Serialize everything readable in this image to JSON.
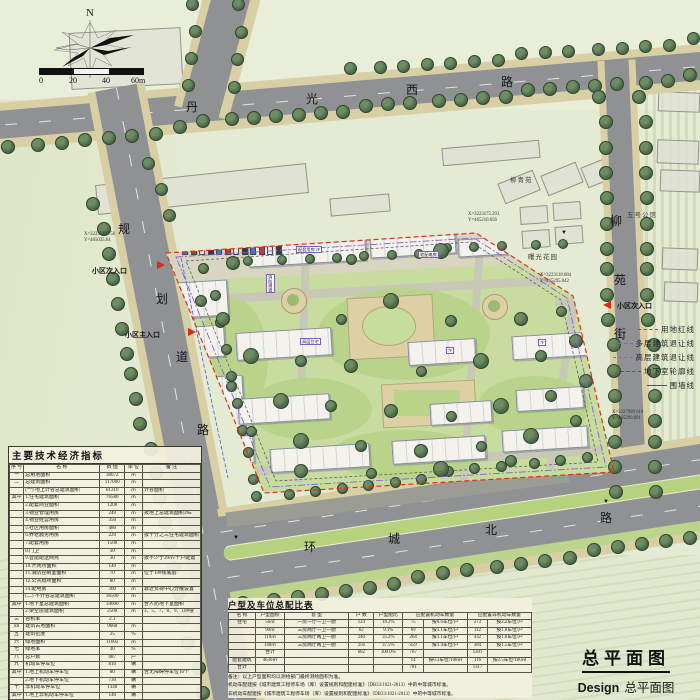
{
  "compass": {
    "north_label": "N"
  },
  "scale_bar": {
    "labels": [
      "0",
      "20",
      "40",
      "60m"
    ]
  },
  "road_name_chars": [
    {
      "text": "丹",
      "x": 186,
      "y": 98
    },
    {
      "text": "光",
      "x": 306,
      "y": 90
    },
    {
      "text": "西",
      "x": 406,
      "y": 81
    },
    {
      "text": "路",
      "x": 501,
      "y": 73
    },
    {
      "text": "规",
      "x": 118,
      "y": 220
    },
    {
      "text": "划",
      "x": 156,
      "y": 290
    },
    {
      "text": "道",
      "x": 176,
      "y": 348
    },
    {
      "text": "路",
      "x": 197,
      "y": 421
    },
    {
      "text": "柳",
      "x": 610,
      "y": 212
    },
    {
      "text": "苑",
      "x": 614,
      "y": 271
    },
    {
      "text": "街",
      "x": 614,
      "y": 325
    },
    {
      "text": "环",
      "x": 304,
      "y": 538
    },
    {
      "text": "城",
      "x": 388,
      "y": 530
    },
    {
      "text": "北",
      "x": 485,
      "y": 521
    },
    {
      "text": "路",
      "x": 600,
      "y": 509
    }
  ],
  "entrances": [
    {
      "label": "小区次入口",
      "lx": 92,
      "ly": 266,
      "ax": 157,
      "ay": 261,
      "dir": "right"
    },
    {
      "label": "小区主入口",
      "lx": 125,
      "ly": 330,
      "ax": 188,
      "ay": 328,
      "dir": "right"
    },
    {
      "label": "小区次入口",
      "lx": 617,
      "ly": 301,
      "ax": 603,
      "ay": 301,
      "dir": "left"
    }
  ],
  "coordinates": [
    {
      "x_label": "X=3223118.756",
      "y_label": "Y=465035.64",
      "px": 84,
      "py": 232
    },
    {
      "x_label": "X=3223175.293",
      "y_label": "Y=465210.656",
      "px": 468,
      "py": 212
    },
    {
      "x_label": "X=3223118.084",
      "y_label": "Y=465295.842",
      "px": 540,
      "py": 273
    },
    {
      "x_label": "X=3227999.618",
      "y_label": "Y=465290.091",
      "px": 612,
      "py": 410
    }
  ],
  "legend": {
    "items": [
      "用地红线",
      "多层建筑退让线",
      "高层建筑退让线",
      "地下室轮廓线",
      "围墙线"
    ]
  },
  "neighbor_labels": [
    {
      "label": "柳青苑",
      "x": 510,
      "y": 174
    },
    {
      "label": "五号公馆",
      "x": 627,
      "y": 209
    },
    {
      "label": "曙光花园",
      "x": 528,
      "y": 251
    }
  ],
  "site_annotations": [
    {
      "label": "配套用房 2F",
      "x": 296,
      "y": 246,
      "vertical": false
    },
    {
      "label": "宅配电房",
      "x": 418,
      "y": 251,
      "vertical": false
    },
    {
      "label": "消防通道",
      "x": 266,
      "y": 274,
      "vertical": true
    },
    {
      "label": "7F",
      "x": 446,
      "y": 347,
      "vertical": false
    },
    {
      "label": "7F",
      "x": 538,
      "y": 339,
      "vertical": false
    },
    {
      "label": "高层住宅",
      "x": 300,
      "y": 338,
      "vertical": false
    }
  ],
  "indicator_table": {
    "title": "主要技术经济指标",
    "headers": [
      "序 号",
      "名  称",
      "数 值",
      "单 位",
      "备  注"
    ],
    "rows": [
      [
        "一",
        "总用地面积",
        "38672",
        "㎡",
        ""
      ],
      [
        "二",
        "总建筑面积",
        "117000",
        "㎡",
        ""
      ],
      [
        "",
        "(一) 地上计容总建筑面积",
        "81210",
        "㎡",
        "计容面积"
      ],
      [
        "其中",
        "1.住宅建筑面积",
        "76580",
        "㎡",
        ""
      ],
      [
        "",
        "2.配套商业面积",
        "1200",
        "㎡",
        ""
      ],
      [
        "",
        "3.物业管理用房",
        "240",
        "㎡",
        "按地上总建筑面积3‰"
      ],
      [
        "",
        "4.物业经营用房",
        "350",
        "㎡",
        ""
      ],
      [
        "",
        "5.社区用房面积",
        "480",
        "㎡",
        ""
      ],
      [
        "",
        "6.养老服务用房",
        "220",
        "㎡",
        "按千分之三住宅建筑面积"
      ],
      [
        "",
        "7.配套用房",
        "1500",
        "㎡",
        ""
      ],
      [
        "",
        "8.门卫",
        "30",
        "㎡",
        ""
      ],
      [
        "",
        "9.智能配送网点",
        "30",
        "㎡",
        "按不少于20㎡/千户配置"
      ],
      [
        "",
        "10.开闭所面积",
        "140",
        "㎡",
        ""
      ],
      [
        "",
        "11.消防控制室面积",
        "70",
        "㎡",
        "位于10#楼底层"
      ],
      [
        "",
        "12.公共厕所面积",
        "80",
        "㎡",
        ""
      ],
      [
        "",
        "14.配电房",
        "300",
        "㎡",
        "靠近负荷中心分散设置"
      ],
      [
        "",
        "(二) 不计容总建筑面积",
        "36500",
        "㎡",
        ""
      ],
      [
        "其中",
        "1.地下室总建筑面积",
        "34000",
        "㎡",
        "含人防地下室面积"
      ],
      [
        "",
        "2.架空层建筑面积",
        "2500",
        "㎡",
        "3、5、7、8、9、10#楼"
      ],
      [
        "三",
        "容积率",
        "2.1",
        "",
        ""
      ],
      [
        "四",
        "建筑占地面积",
        "9668",
        "㎡",
        ""
      ],
      [
        "五",
        "建筑密度",
        "25",
        "%",
        ""
      ],
      [
        "六",
        "绿地面积",
        "11602",
        "㎡",
        ""
      ],
      [
        "七",
        "绿地率",
        "30",
        "%",
        ""
      ],
      [
        "八",
        "总户数",
        "687",
        "户",
        ""
      ],
      [
        "九",
        "机动车停车位",
        "810",
        "辆",
        ""
      ],
      [
        "其中",
        "1.地上机动车停车位",
        "80",
        "辆",
        "含无障碍停车位16个"
      ],
      [
        "",
        "2.地下机动车停车位",
        "730",
        "辆",
        ""
      ],
      [
        "十",
        "非机动车停车位",
        "1340",
        "辆",
        ""
      ],
      [
        "其中",
        "1.地上非机动车停车位",
        "140",
        "辆",
        ""
      ],
      [
        "",
        "2.地下非机动车停车位",
        "1200",
        "辆",
        ""
      ]
    ]
  },
  "parking_table": {
    "title": "户型及车位总配比表",
    "headers": [
      {
        "t": "名 称",
        "s": 1
      },
      {
        "t": "户型面积",
        "s": 1
      },
      {
        "t": "套  型",
        "s": 1
      },
      {
        "t": "户 数",
        "s": 1
      },
      {
        "t": "户型配比",
        "s": 1
      },
      {
        "t": "应配置机动车数量",
        "s": 2
      },
      {
        "t": "应配置非机动车数量",
        "s": 2
      }
    ],
    "rows": [
      [
        "住宅",
        "56㎡",
        "一房一厅一卫一厨",
        "124",
        "18.2%",
        "75",
        "按0.6车位/户",
        "273",
        "按2.2车位/户"
      ],
      [
        "",
        "90㎡",
        "三房两厅一卫一厨",
        "62",
        "9.1%",
        "69",
        "按1.1车位/户",
        "112",
        "按1.8车位/户"
      ],
      [
        "",
        "110㎡",
        "三房两厅两卫一厨",
        "240",
        "35.2%",
        "264",
        "按1.1车位/户",
        "432",
        "按1.8车位/户"
      ],
      [
        "",
        "140㎡",
        "三房两厅两卫一厨",
        "256",
        "37.5%",
        "359",
        "按1.4车位/户",
        "384",
        "按1.5车位/户"
      ],
      [
        "",
        "合计",
        "",
        "682",
        "100.0%",
        "767",
        "",
        "1201",
        ""
      ],
      [
        "配套建筑",
        "4630㎡",
        "",
        "",
        "",
        "14",
        "按0.3车位/100㎡",
        "116",
        "按2.5车位/100㎡"
      ],
      [
        "合计",
        "",
        "",
        "",
        "",
        "781",
        "",
        "1317",
        ""
      ]
    ],
    "notes": [
      "备注：以上户型面积均以测绘部门最终测绘面积为准。",
      "机动车配建按《城市建筑工程停车场（库）设置规则和配建标准》（DB33/1021-2013）中的中等城市标准。",
      "非机动车配建按《城市建筑工程停车场（库）设置规则和配建标准》（DB33/1021-2013）中的中等城市标准。"
    ]
  },
  "title_block": {
    "title": "总平面图",
    "design_label": "Design",
    "design_title": "总平面图"
  }
}
